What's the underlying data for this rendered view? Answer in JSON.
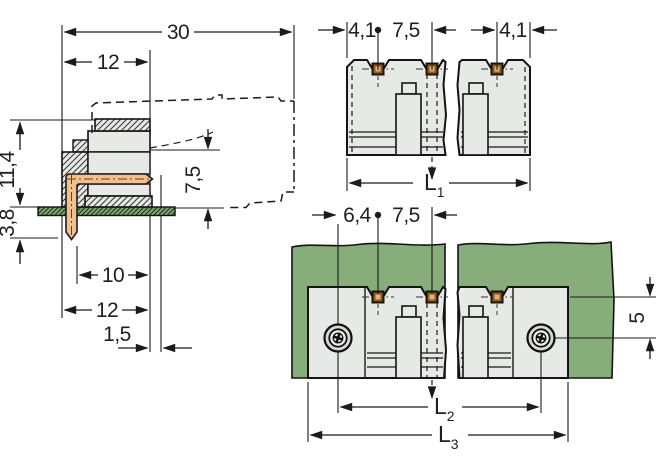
{
  "drawing": {
    "kind": "connector-dimension-drawing",
    "colors": {
      "body_gray": "#e7e9e6",
      "pcb_green": "#87ad7b",
      "pin_copper": "#f2c08d",
      "pin_contact_dark": "#8a5a24",
      "pin_contact_light": "#e8b06a",
      "line": "#1b1b1b"
    },
    "side_view": {
      "name": "side cross-section view",
      "d30": "30",
      "d12_top": "12",
      "d11_4": "11,4",
      "d3_8": "3,8",
      "d7_5": "7,5",
      "d10": "10",
      "d12_bottom": "12",
      "d1_5": "1,5"
    },
    "top_view": {
      "name": "top view",
      "d4_1_left": "4,1",
      "d7_5": "7,5",
      "d4_1_right": "4,1",
      "L1": {
        "base": "L",
        "sub": "1"
      }
    },
    "board_view": {
      "name": "view mounted on PCB",
      "d6_4": "6,4",
      "d7_5": "7,5",
      "d5": "5",
      "L2": {
        "base": "L",
        "sub": "2"
      },
      "L3": {
        "base": "L",
        "sub": "3"
      }
    }
  }
}
